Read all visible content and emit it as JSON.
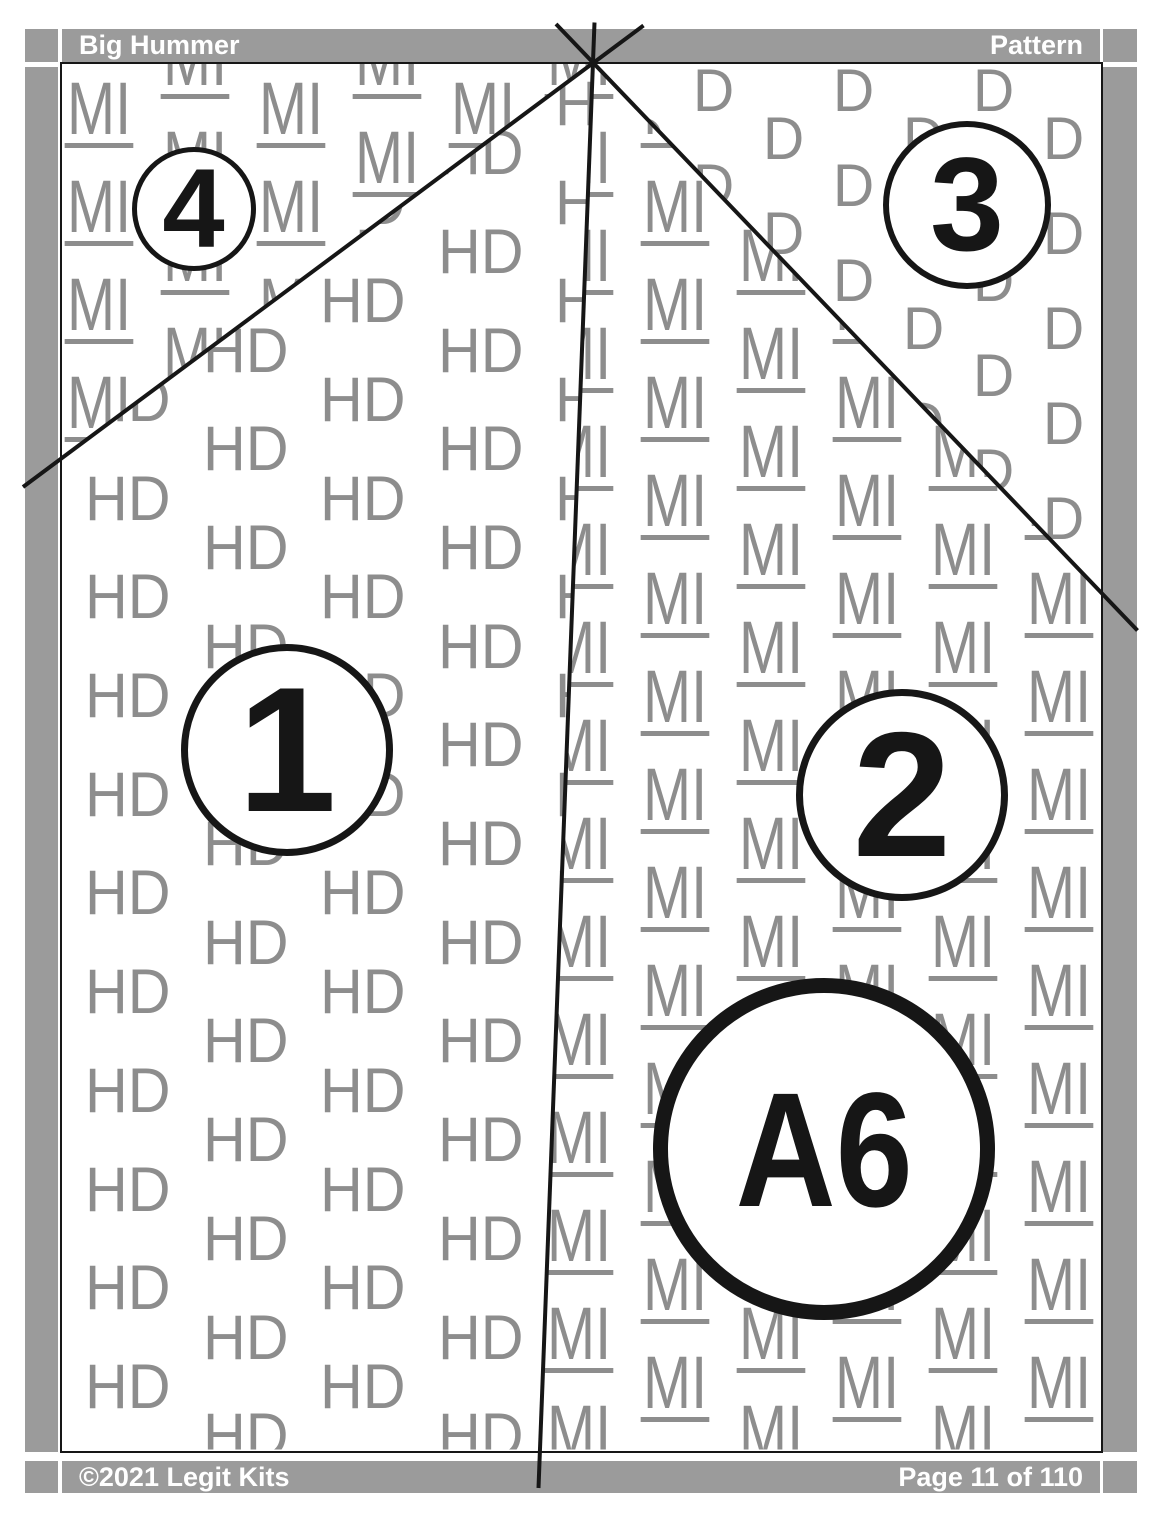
{
  "header": {
    "title": "Big Hummer",
    "right_label": "Pattern"
  },
  "footer": {
    "copyright": "©2021 Legit Kits",
    "page_indicator": "Page 11 of 110"
  },
  "pattern": {
    "sections": [
      {
        "id": "1",
        "label": "1",
        "fabric_code": "HD",
        "underlined": false
      },
      {
        "id": "2",
        "label": "2",
        "fabric_code": "MI",
        "underlined": true
      },
      {
        "id": "3",
        "label": "3",
        "fabric_code": "D",
        "underlined": false
      },
      {
        "id": "4",
        "label": "4",
        "fabric_code": "MI",
        "underlined": true
      }
    ],
    "piece_label": "A6"
  },
  "colors": {
    "bar_gray": "#9b9b9b",
    "watermark_gray": "#8d8d8d",
    "line_black": "#161616",
    "bar_text_white": "#ffffff",
    "page_bg": "#ffffff"
  }
}
